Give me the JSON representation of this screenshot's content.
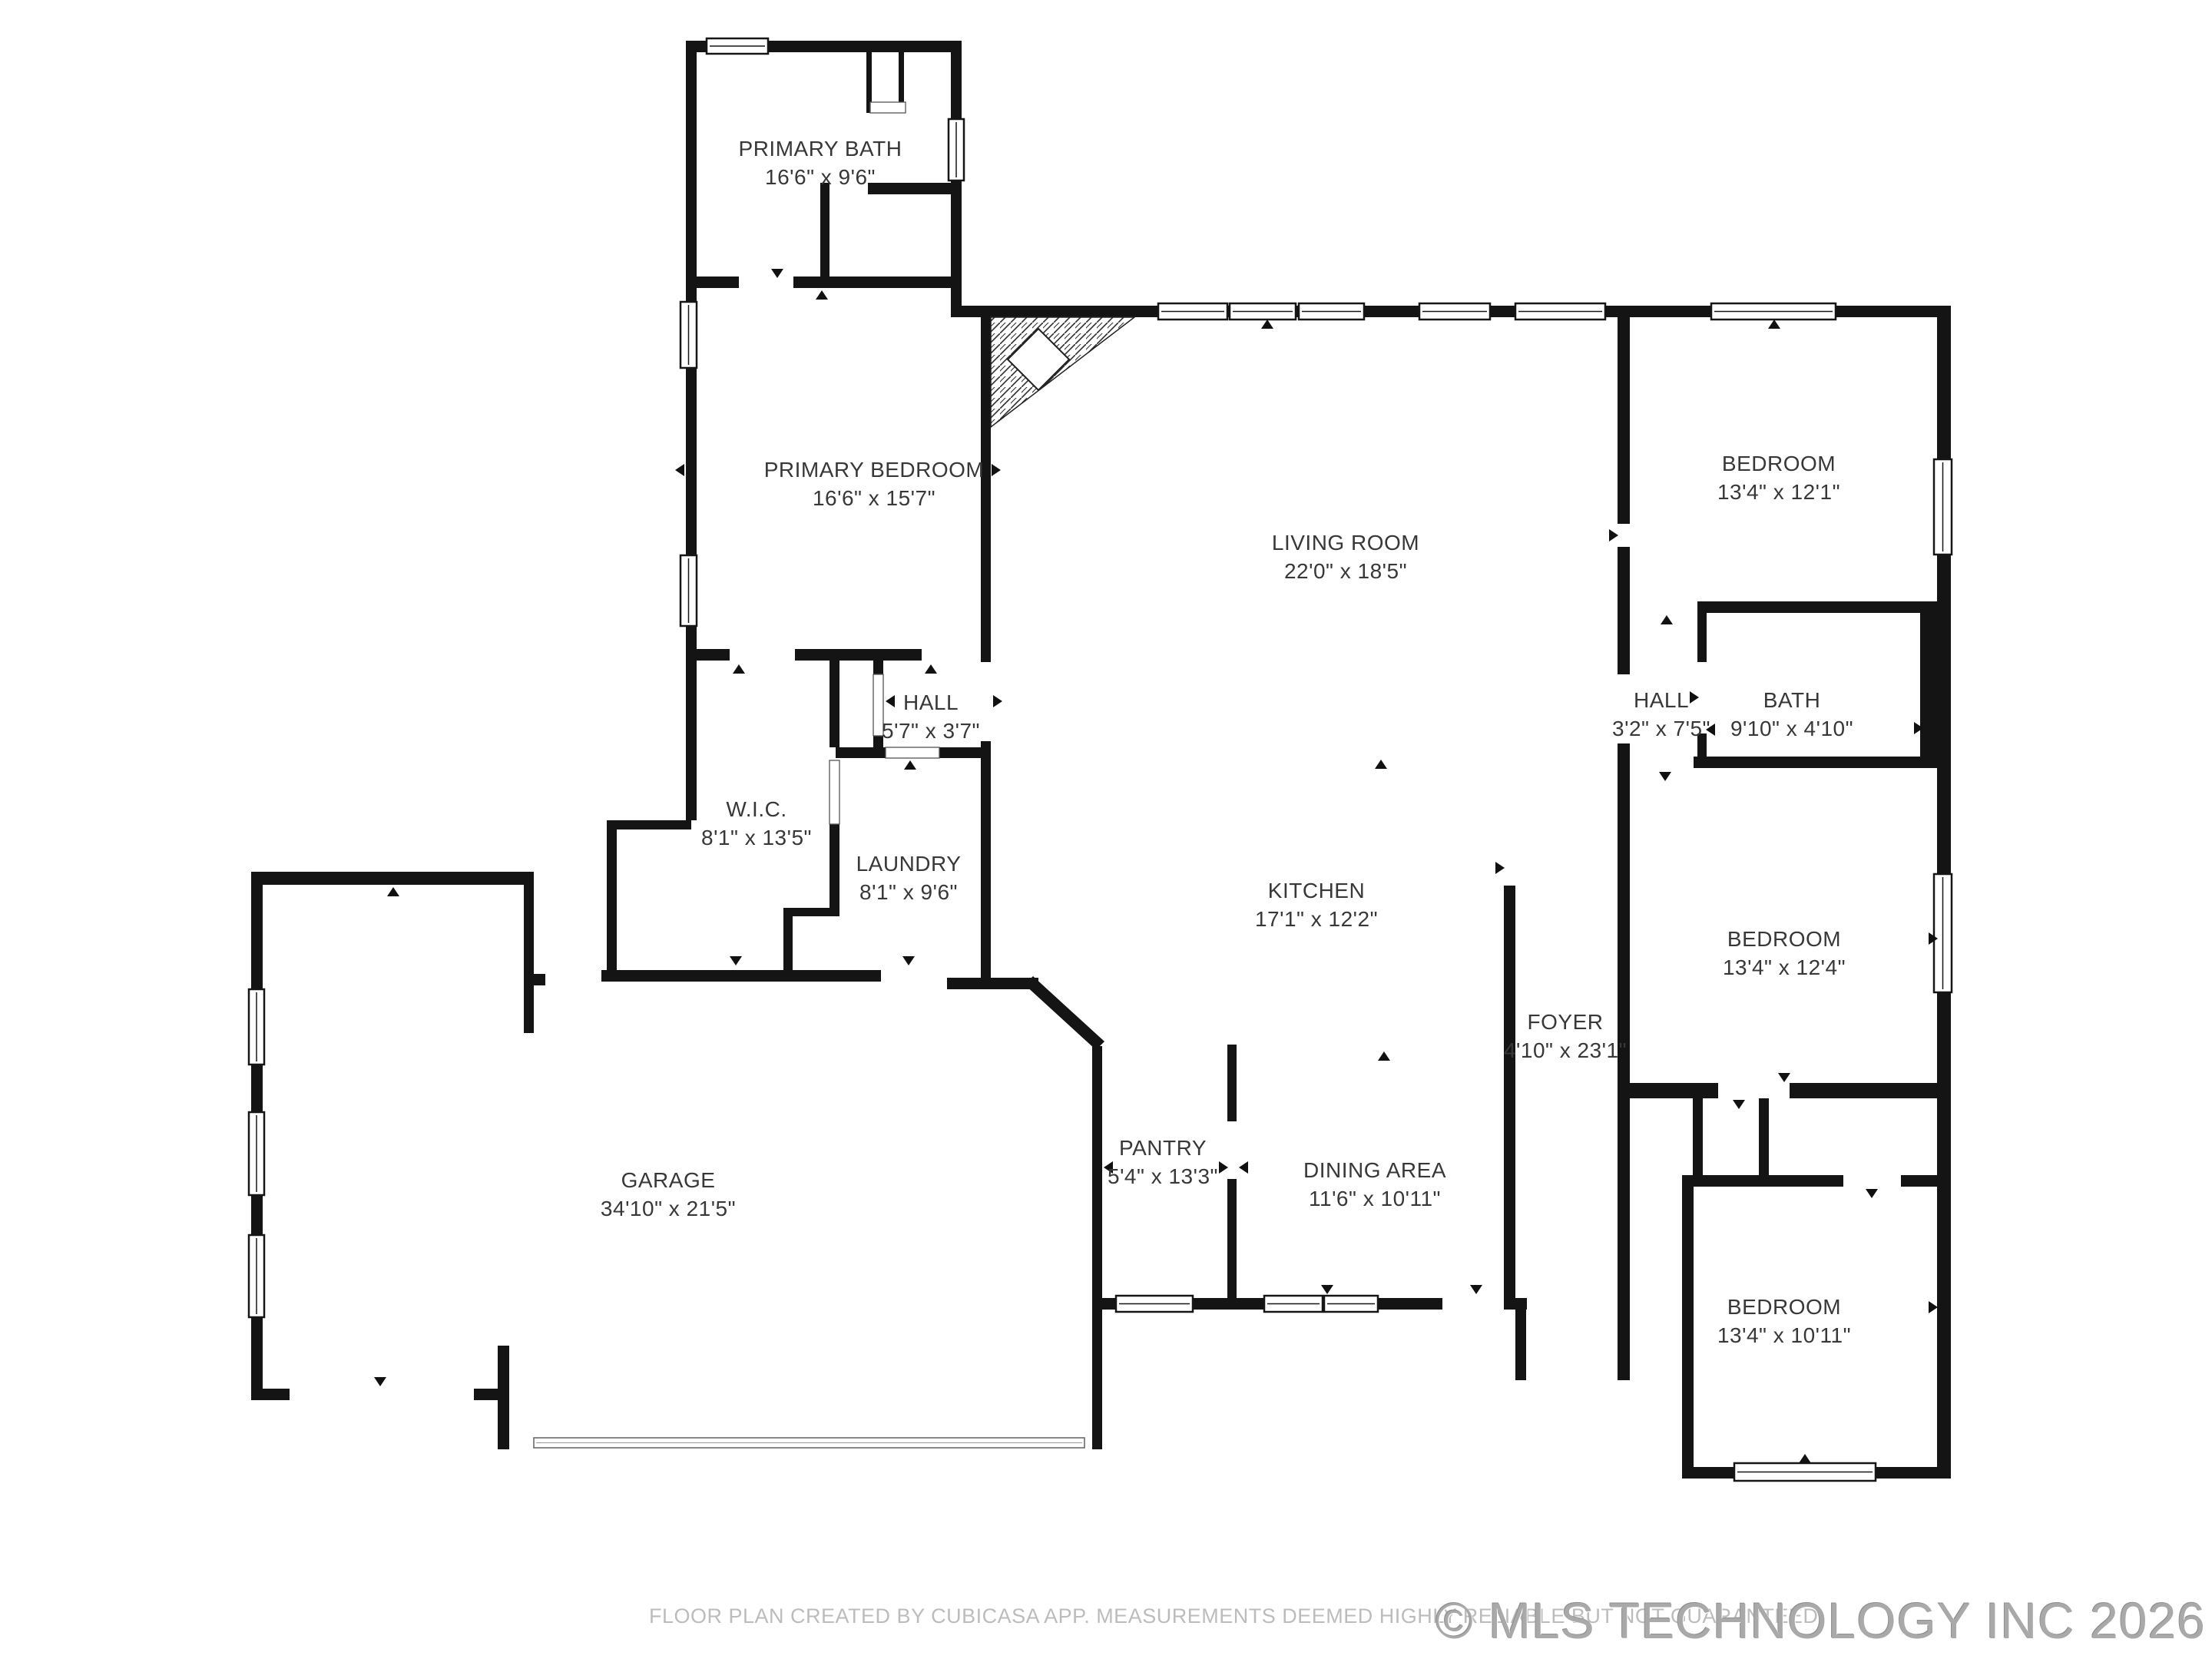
{
  "page": {
    "title": "Floor plan"
  },
  "colors": {
    "wall": "#141414",
    "label": "#383838",
    "footer_text": "#bcbcbc",
    "watermark_text": "#a9a9a9"
  },
  "rooms": [
    {
      "name": "PRIMARY BATH",
      "dims": "16'6\" x 9'6\""
    },
    {
      "name": "PRIMARY BEDROOM",
      "dims": "16'6\" x 15'7\""
    },
    {
      "name": "LIVING ROOM",
      "dims": "22'0\" x 18'5\""
    },
    {
      "name": "BEDROOM",
      "dims": "13'4\" x 12'1\""
    },
    {
      "name": "HALL",
      "dims": "3'2\" x 7'5\""
    },
    {
      "name": "BATH",
      "dims": "9'10\" x 4'10\""
    },
    {
      "name": "HALL",
      "dims": "5'7\" x 3'7\""
    },
    {
      "name": "W.I.C.",
      "dims": "8'1\" x 13'5\""
    },
    {
      "name": "LAUNDRY",
      "dims": "8'1\" x 9'6\""
    },
    {
      "name": "KITCHEN",
      "dims": "17'1\" x 12'2\""
    },
    {
      "name": "BEDROOM",
      "dims": "13'4\" x 12'4\""
    },
    {
      "name": "FOYER",
      "dims": "4'10\" x 23'1\""
    },
    {
      "name": "PANTRY",
      "dims": "5'4\" x 13'3\""
    },
    {
      "name": "DINING AREA",
      "dims": "11'6\" x 10'11\""
    },
    {
      "name": "GARAGE",
      "dims": "34'10\" x 21'5\""
    },
    {
      "name": "BEDROOM",
      "dims": "13'4\" x 10'11\""
    }
  ],
  "footer": {
    "disclaimer": "FLOOR PLAN CREATED BY CUBICASA APP. MEASUREMENTS DEEMED HIGHLY RELIABLE BUT NOT GUARANTEED.",
    "watermark": "© MLS TECHNOLOGY INC 2026"
  }
}
